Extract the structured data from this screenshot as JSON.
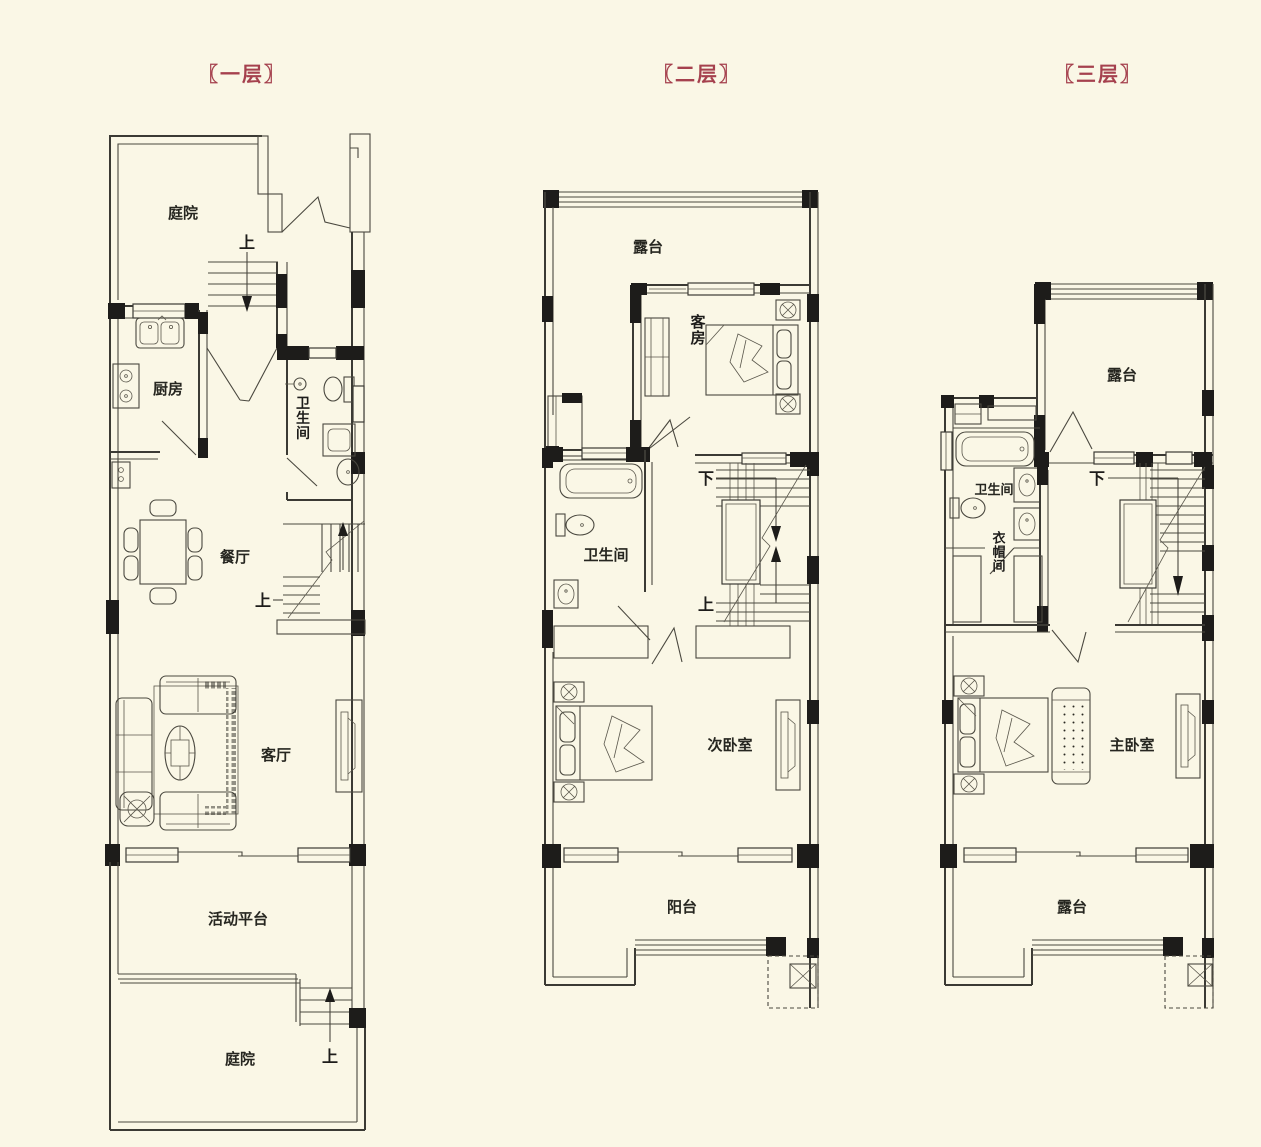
{
  "page": {
    "background": "#FAF7E6",
    "line_color": "#3B3A34",
    "wall_color": "#1D1C1A",
    "title_color": "#A5414E"
  },
  "floor1": {
    "title": "〖一层〗",
    "courtyard_top": "庭院",
    "stairs_up_top": "上",
    "kitchen": "厨房",
    "bathroom": "卫生间",
    "dining": "餐厅",
    "stairs_up_mid": "上",
    "living": "客厅",
    "platform": "活动平台",
    "courtyard_bottom": "庭院",
    "stairs_up_bottom": "上"
  },
  "floor2": {
    "title": "〖二层〗",
    "terrace": "露台",
    "guest_room": "客房",
    "bathroom": "卫生间",
    "stairs_down": "下",
    "stairs_up": "上",
    "bedroom": "次卧室",
    "balcony": "阳台"
  },
  "floor3": {
    "title": "〖三层〗",
    "terrace_top": "露台",
    "bathroom": "卫生间",
    "cloakroom": "衣帽间",
    "stairs_down": "下",
    "master_bedroom": "主卧室",
    "terrace_bottom": "露台"
  }
}
